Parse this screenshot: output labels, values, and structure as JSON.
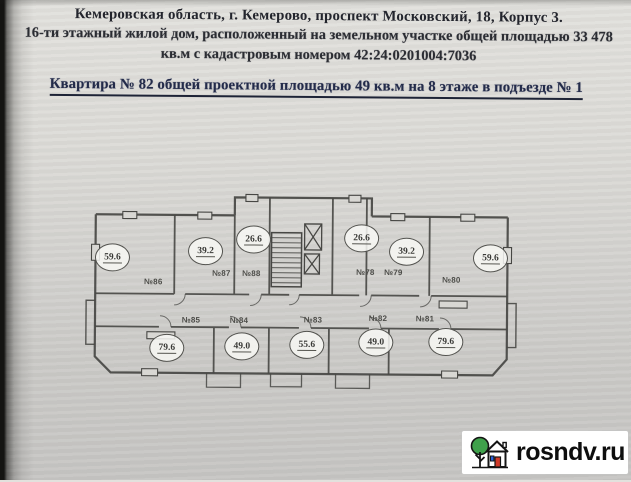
{
  "document": {
    "header": {
      "line1": "Кемеровская область, г. Кемерово,  проспект Московский, 18, Корпус 3.",
      "line2": "16-ти этажный жилой дом, расположенный на земельном участке общей площадью 33 478",
      "line3": "кв.м с кадастровым номером 42:24:0201004:7036"
    },
    "title": "Квартира № 82 общей проектной площадью 49 кв.м на 8 этаже в подъезде № 1"
  },
  "floor_plan": {
    "top_row": [
      {
        "number": "№86",
        "area": "59.6"
      },
      {
        "number": "№87",
        "area": "39.2"
      },
      {
        "number": "№88",
        "area": "26.6"
      },
      {
        "number": "№78",
        "area": "26.6"
      },
      {
        "number": "№79",
        "area": "39.2"
      },
      {
        "number": "№80",
        "area": "59.6"
      }
    ],
    "bottom_row": [
      {
        "number": "№85",
        "area": "79.6"
      },
      {
        "number": "№84",
        "area": "49.0"
      },
      {
        "number": "№83",
        "area": "55.6"
      },
      {
        "number": "№82",
        "area": "49.0"
      },
      {
        "number": "№81",
        "area": "79.6"
      }
    ]
  },
  "watermark": {
    "text": "rosndv.ru"
  },
  "colors": {
    "paper": "#d9d8d4",
    "header_ink": "#25272e",
    "title_ink": "#232b4a",
    "plan_line": "#474744",
    "watermark_bg": "#ffffff",
    "watermark_text": "#0e0e0e",
    "logo_green": "#3fa14b",
    "logo_red": "#d23b2a",
    "logo_blue": "#2b5fd9"
  }
}
